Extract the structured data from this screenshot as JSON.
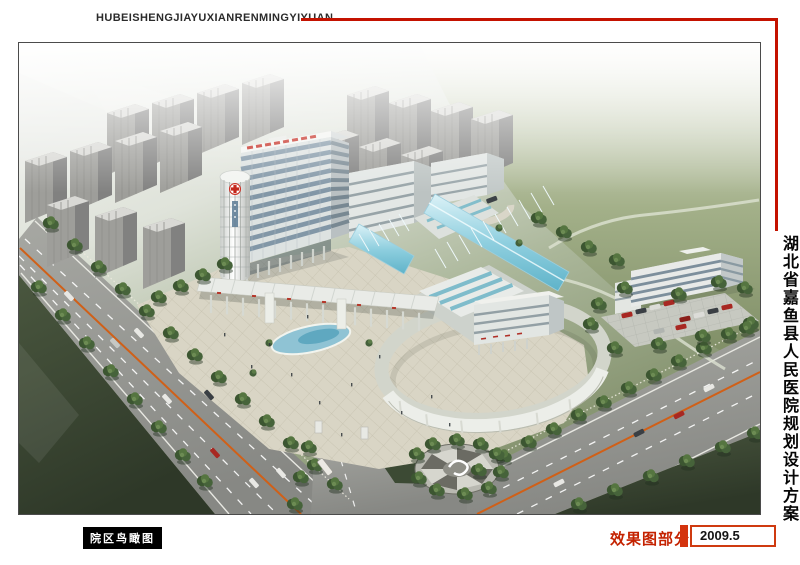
{
  "header": {
    "title_pinyin": "HUBEISHENGJIAYUXIANRENMINGYIYUAN"
  },
  "side": {
    "title_cn": "湖北省嘉鱼县人民医院规划设计方案"
  },
  "footer": {
    "caption": "院区鸟瞰图",
    "section_label": "效果图部分",
    "date": "2009.5"
  },
  "colors": {
    "accent_red": "#c41200",
    "caption_bg": "#000000",
    "frame_border": "#4b4b4b",
    "grass_dark": "#3c4a34",
    "lawn_green": "#8e9c78",
    "glass_cyan": "#8fcfdf"
  }
}
